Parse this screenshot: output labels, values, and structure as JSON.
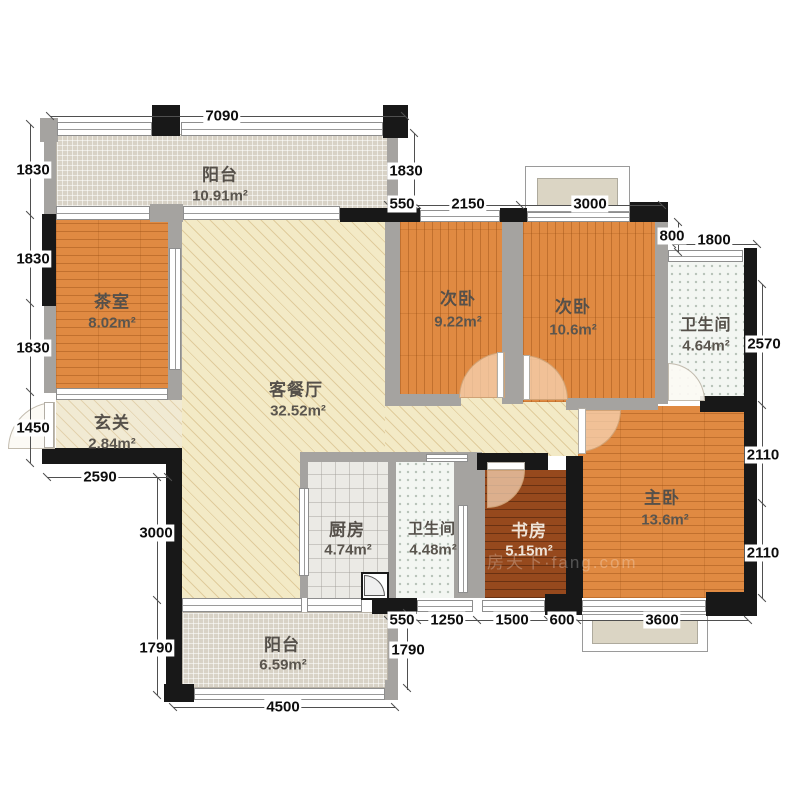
{
  "floorplan": {
    "watermark": "房天下·fang.com",
    "rooms": {
      "balcony_top": {
        "name": "阳台",
        "area": "10.91m²"
      },
      "tea_room": {
        "name": "茶室",
        "area": "8.02m²"
      },
      "living_dining": {
        "name": "客餐厅",
        "area": "32.52m²"
      },
      "bedroom_left": {
        "name": "次卧",
        "area": "9.22m²"
      },
      "bedroom_right": {
        "name": "次卧",
        "area": "10.6m²"
      },
      "bathroom_top": {
        "name": "卫生间",
        "area": "4.64m²"
      },
      "entry": {
        "name": "玄关",
        "area": "2.84m²"
      },
      "master_bedroom": {
        "name": "主卧",
        "area": "13.6m²"
      },
      "study": {
        "name": "书房",
        "area": "5.15m²"
      },
      "kitchen": {
        "name": "厨房",
        "area": "4.74m²"
      },
      "bathroom_bottom": {
        "name": "卫生间",
        "area": "4.48m²"
      },
      "balcony_bottom": {
        "name": "阳台",
        "area": "6.59m²"
      }
    },
    "dims": {
      "top": [
        "7090"
      ],
      "upper_row": [
        "550",
        "2150",
        "3000"
      ],
      "balcony_right": [
        "1830"
      ],
      "step": [
        "800",
        "1800"
      ],
      "left": [
        "1830",
        "1830",
        "1830",
        "1450"
      ],
      "left_lower": [
        "2590",
        "3000",
        "1790"
      ],
      "right": [
        "2570",
        "2110",
        "2110"
      ],
      "bottom_row": [
        "550",
        "1250",
        "1500",
        "600",
        "3600"
      ],
      "bottom": [
        "1790",
        "4500"
      ]
    }
  }
}
